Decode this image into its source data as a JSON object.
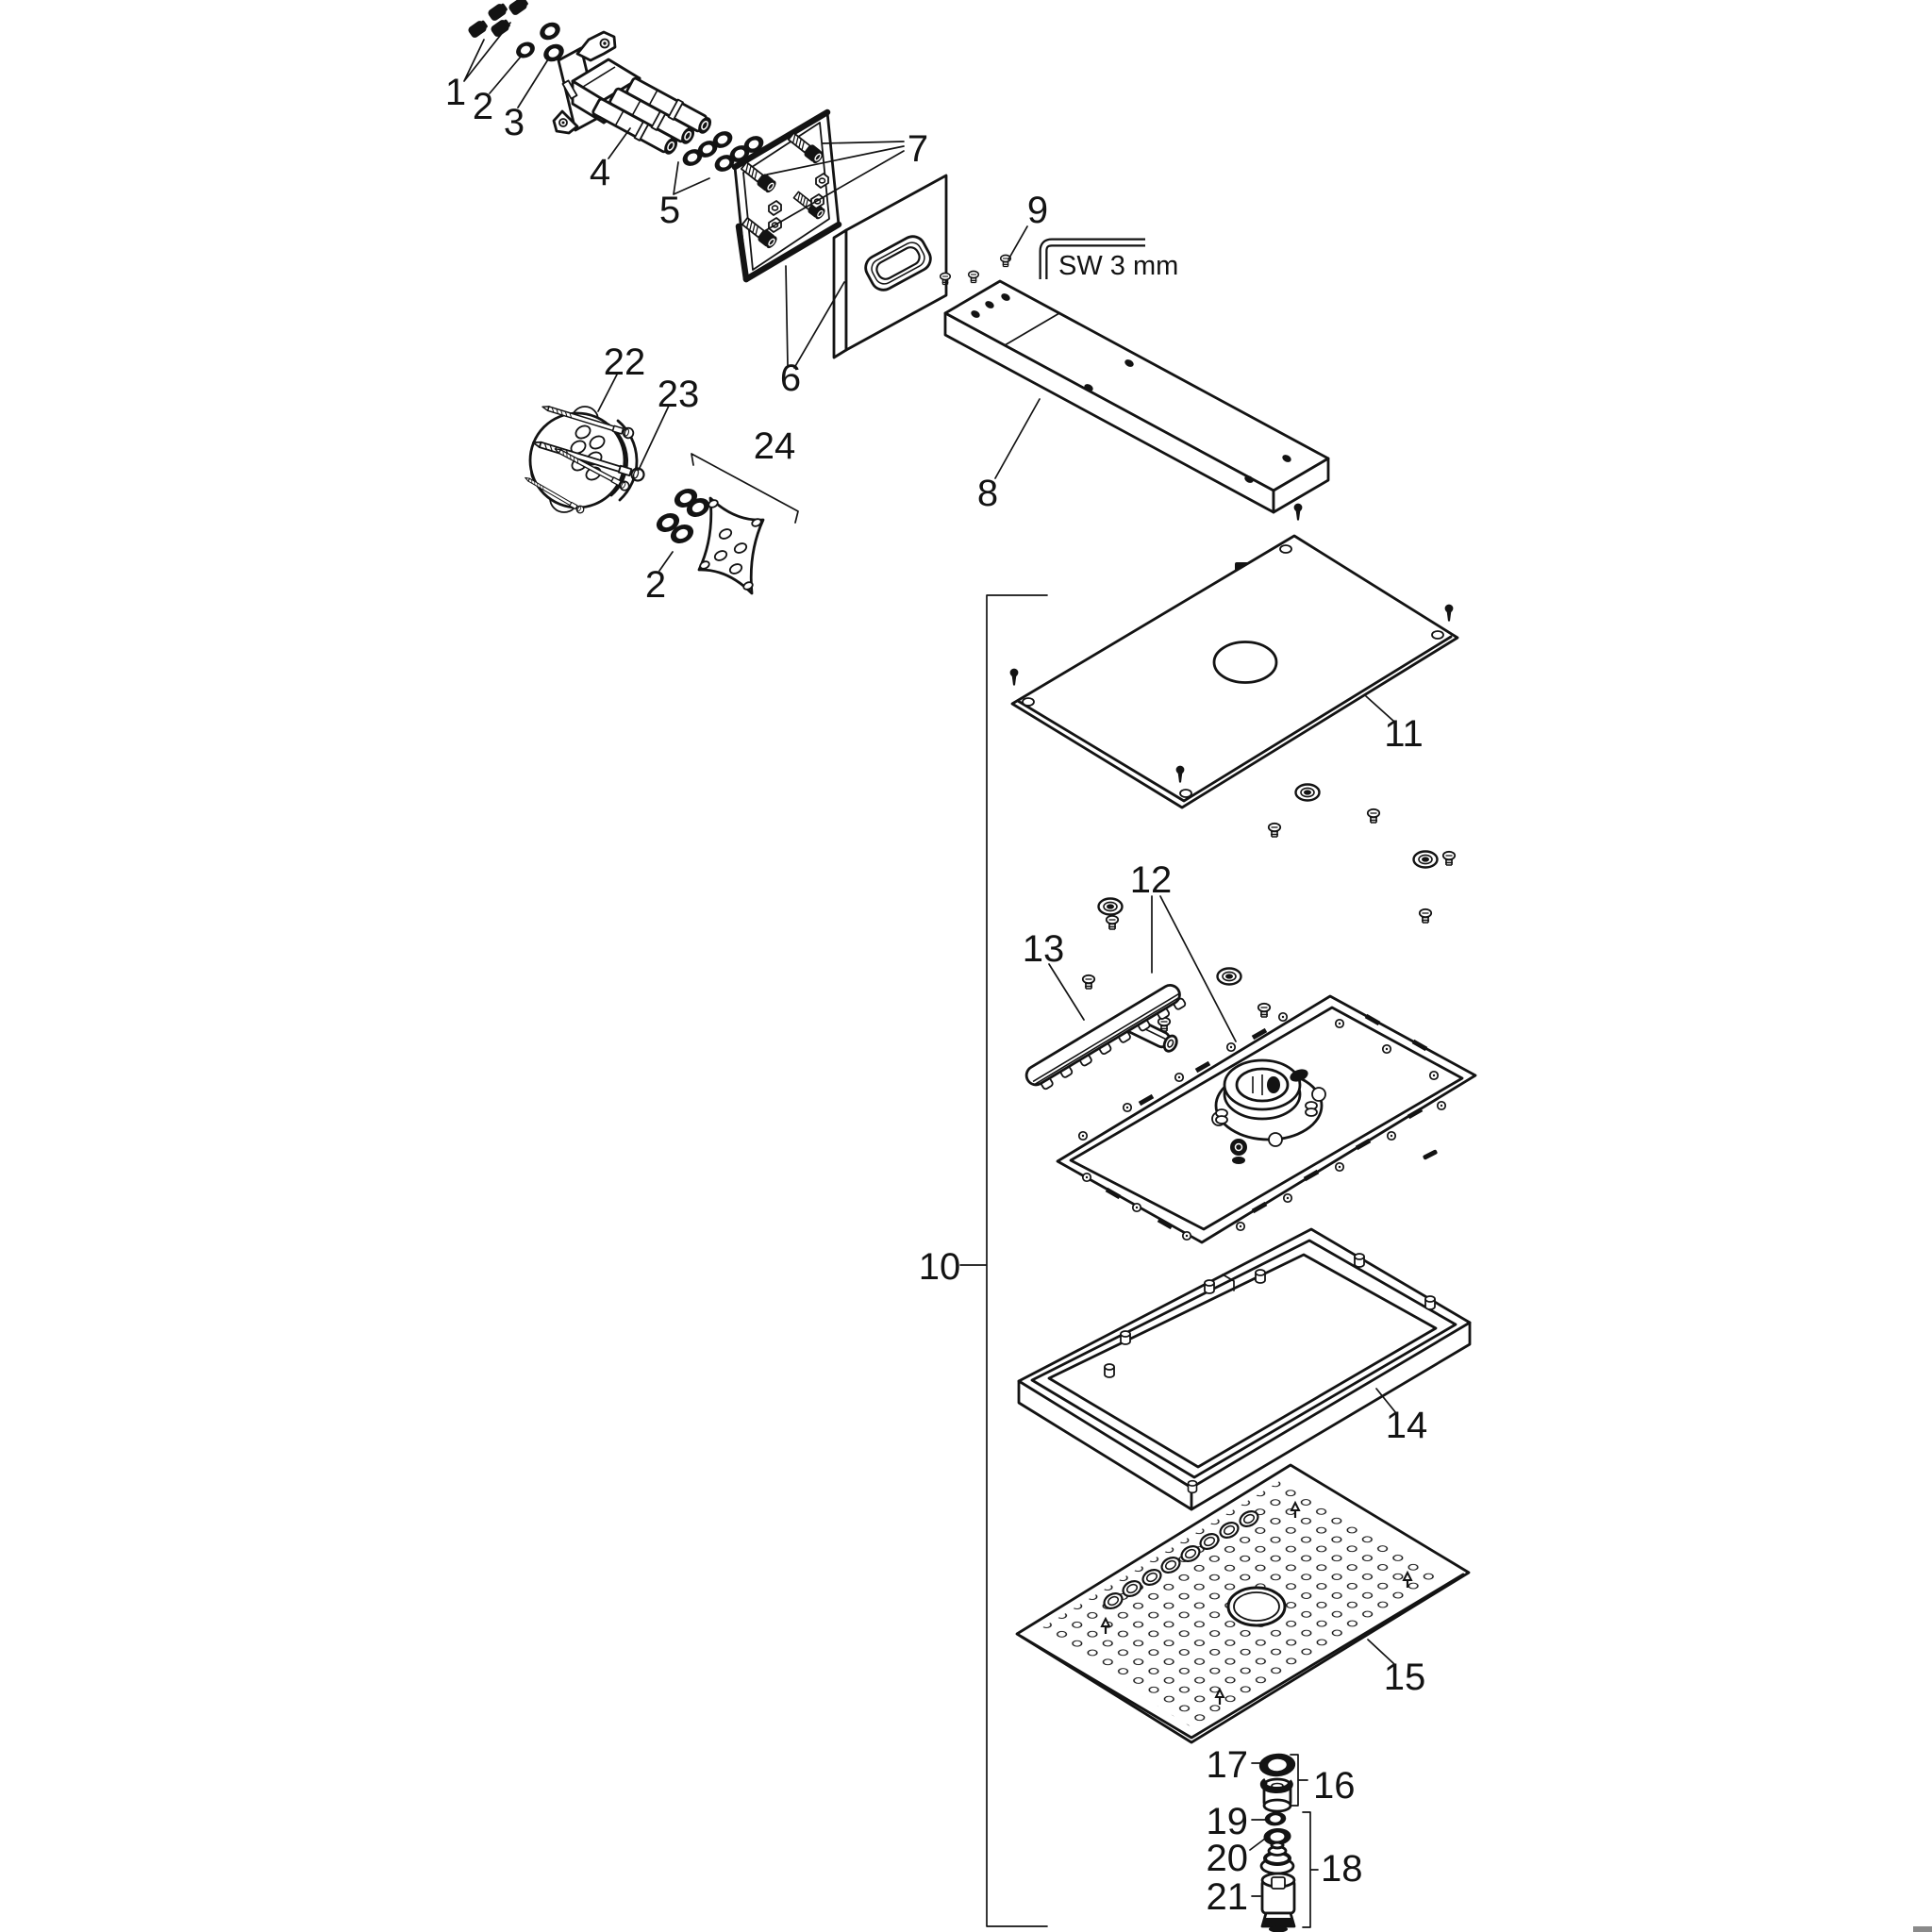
{
  "diagram": {
    "type": "exploded-parts-diagram",
    "background_color": "#ffffff",
    "line_color": "#131313",
    "tool_label": "SW 3 mm",
    "callouts": [
      "1",
      "2",
      "3",
      "4",
      "5",
      "6",
      "7",
      "8",
      "9",
      "10",
      "11",
      "12",
      "13",
      "14",
      "15",
      "16",
      "17",
      "18",
      "19",
      "20",
      "21",
      "22",
      "23",
      "24"
    ],
    "duplicate_callouts": {
      "o_ring_set": "2"
    }
  }
}
